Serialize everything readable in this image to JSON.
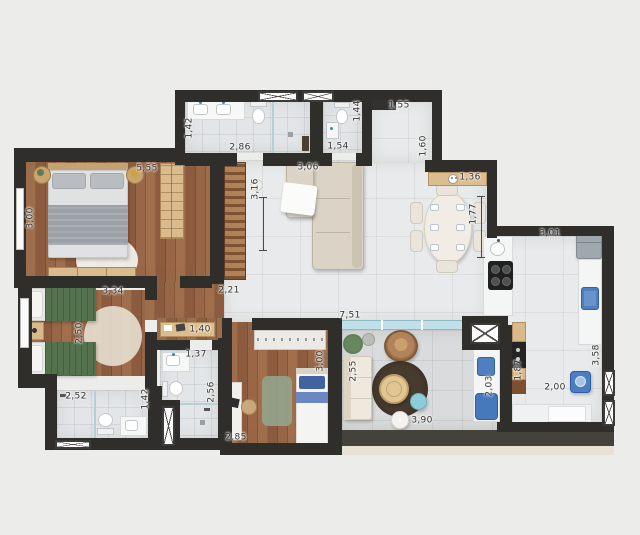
{
  "plan": {
    "background_color": "#ececeb",
    "wall_color": "#2f2e2a",
    "wood_floor_color": "#96664a",
    "tile_floor_color": "#e8eaeb",
    "balcony_tile_color": "#d9dbdc",
    "cabinet_tan_color": "#d9b98c",
    "appliance_blue_color": "#4a7ec0",
    "glass_color": "#bfe0e8",
    "icons": {
      "bar": "service-dots-icon"
    },
    "dimension_labels": [
      {
        "text": "5,55",
        "x": 147,
        "y": 169,
        "rot": 0
      },
      {
        "text": "1,42",
        "x": 190,
        "y": 128,
        "rot": 90
      },
      {
        "text": "2,86",
        "x": 240,
        "y": 148,
        "rot": 0
      },
      {
        "text": "3,06",
        "x": 308,
        "y": 168,
        "rot": 0
      },
      {
        "text": "3,16",
        "x": 256,
        "y": 189,
        "rot": 90
      },
      {
        "text": "1,44",
        "x": 358,
        "y": 111,
        "rot": 90
      },
      {
        "text": "1,54",
        "x": 338,
        "y": 147,
        "rot": 0
      },
      {
        "text": "1,55",
        "x": 399,
        "y": 106,
        "rot": 0
      },
      {
        "text": "1,60",
        "x": 424,
        "y": 146,
        "rot": 90
      },
      {
        "text": "1,36",
        "x": 470,
        "y": 178,
        "rot": 0
      },
      {
        "text": "1,77",
        "x": 474,
        "y": 214,
        "rot": 90
      },
      {
        "text": "3,01",
        "x": 550,
        "y": 234,
        "rot": 0
      },
      {
        "text": "3,00",
        "x": 31,
        "y": 218,
        "rot": 90
      },
      {
        "text": "3,34",
        "x": 113,
        "y": 292,
        "rot": 0
      },
      {
        "text": "2,21",
        "x": 229,
        "y": 291,
        "rot": 0
      },
      {
        "text": "2,50",
        "x": 80,
        "y": 333,
        "rot": 90
      },
      {
        "text": "1,40",
        "x": 200,
        "y": 330,
        "rot": 0
      },
      {
        "text": "1,37",
        "x": 196,
        "y": 355,
        "rot": 0
      },
      {
        "text": "2,56",
        "x": 212,
        "y": 392,
        "rot": 90
      },
      {
        "text": "2,52",
        "x": 76,
        "y": 397,
        "rot": 0
      },
      {
        "text": "1,42",
        "x": 146,
        "y": 399,
        "rot": 90
      },
      {
        "text": "2,85",
        "x": 236,
        "y": 438,
        "rot": 0
      },
      {
        "text": "3,00",
        "x": 321,
        "y": 361,
        "rot": 90
      },
      {
        "text": "7,51",
        "x": 350,
        "y": 316,
        "rot": 0
      },
      {
        "text": "2,55",
        "x": 354,
        "y": 371,
        "rot": 90
      },
      {
        "text": "3,90",
        "x": 422,
        "y": 421,
        "rot": 0
      },
      {
        "text": "2,03",
        "x": 490,
        "y": 386,
        "rot": 90
      },
      {
        "text": "1,87",
        "x": 519,
        "y": 370,
        "rot": 90
      },
      {
        "text": "2,00",
        "x": 555,
        "y": 388,
        "rot": 0
      },
      {
        "text": "3,58",
        "x": 597,
        "y": 355,
        "rot": 90
      }
    ]
  }
}
